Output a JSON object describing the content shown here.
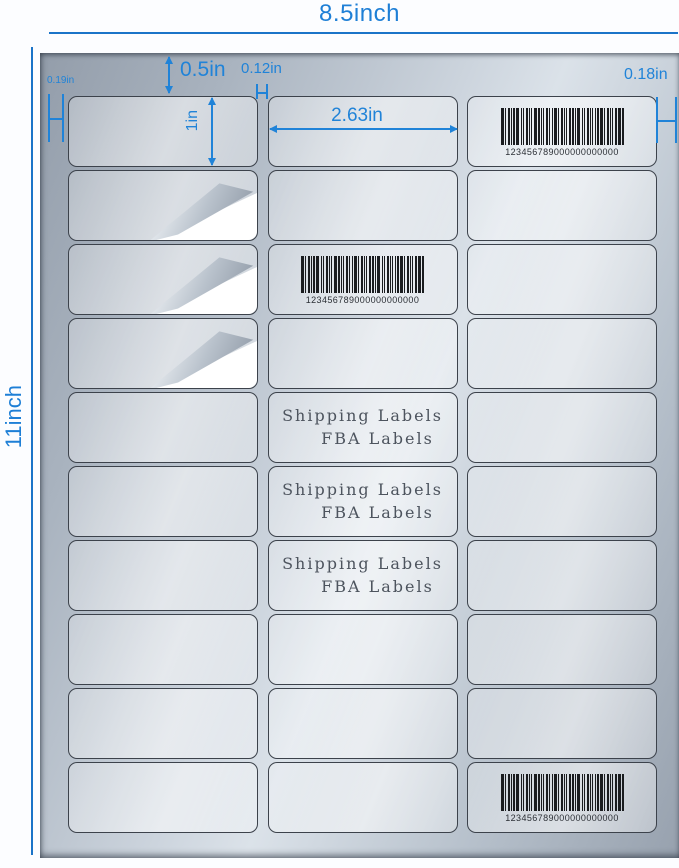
{
  "page": {
    "width_label": "8.5inch",
    "height_label": "11inch"
  },
  "annotations": {
    "top_margin": "0.5in",
    "column_gap": "0.12in",
    "left_margin": "0.19in",
    "right_margin": "0.18in",
    "label_width": "2.63in",
    "label_height": "1in"
  },
  "grid": {
    "rows": 10,
    "cols": 3
  },
  "cells": [
    {
      "row": 0,
      "col": 2,
      "type": "barcode"
    },
    {
      "row": 1,
      "col": 0,
      "type": "peel"
    },
    {
      "row": 2,
      "col": 0,
      "type": "peel"
    },
    {
      "row": 2,
      "col": 1,
      "type": "barcode"
    },
    {
      "row": 3,
      "col": 0,
      "type": "peel"
    },
    {
      "row": 4,
      "col": 1,
      "type": "text"
    },
    {
      "row": 5,
      "col": 1,
      "type": "text"
    },
    {
      "row": 6,
      "col": 1,
      "type": "text"
    },
    {
      "row": 9,
      "col": 2,
      "type": "barcode"
    }
  ],
  "barcode": {
    "number": "123456789000000000000"
  },
  "label_text": {
    "line1": "Shipping Labels",
    "line2": "FBA Labels"
  },
  "colors": {
    "dimension_blue": "#2083d8",
    "sheet_silver_light": "#dbe2e9",
    "sheet_silver_dark": "#939daa",
    "barcode_black": "#1a1c1f",
    "label_text_gray": "#4d545e"
  }
}
